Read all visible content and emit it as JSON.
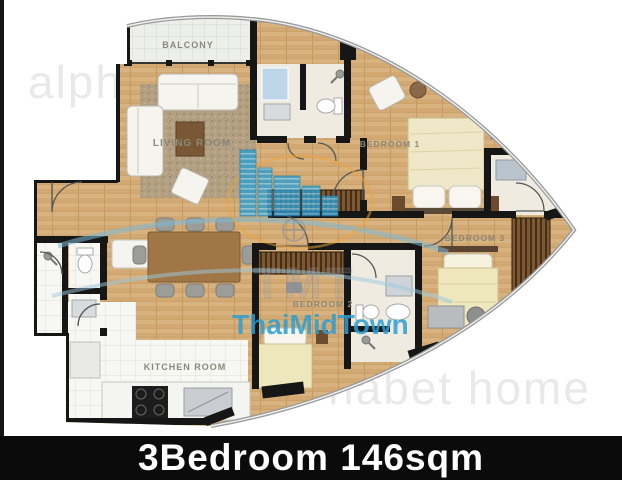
{
  "image": {
    "type": "apartment-floor-plan"
  },
  "footer": {
    "title": "3Bedroom 146sqm"
  },
  "room_labels": {
    "balcony": "BALCONY",
    "living_room": "LIVING ROOM",
    "bedroom_1": "BEDROOM 1",
    "bedroom_2": "BEDROOM 2",
    "bedroom_3": "BEDROOM 3",
    "kitchen": "KITCHEN ROOM"
  },
  "watermarks": {
    "alphabet_partial_top": "alph",
    "alphabet_partial_bottom": "habet home",
    "brand": "ThaiMidTown",
    "brand_monogram": "TMT"
  },
  "colors": {
    "wood_floor": "#d6b07c",
    "wall": "#161616",
    "brand_blue": "#2f9fd0",
    "accent_orange": "#eda53a",
    "footer_bg": "#0b0b0b",
    "footer_text": "#ffffff"
  }
}
